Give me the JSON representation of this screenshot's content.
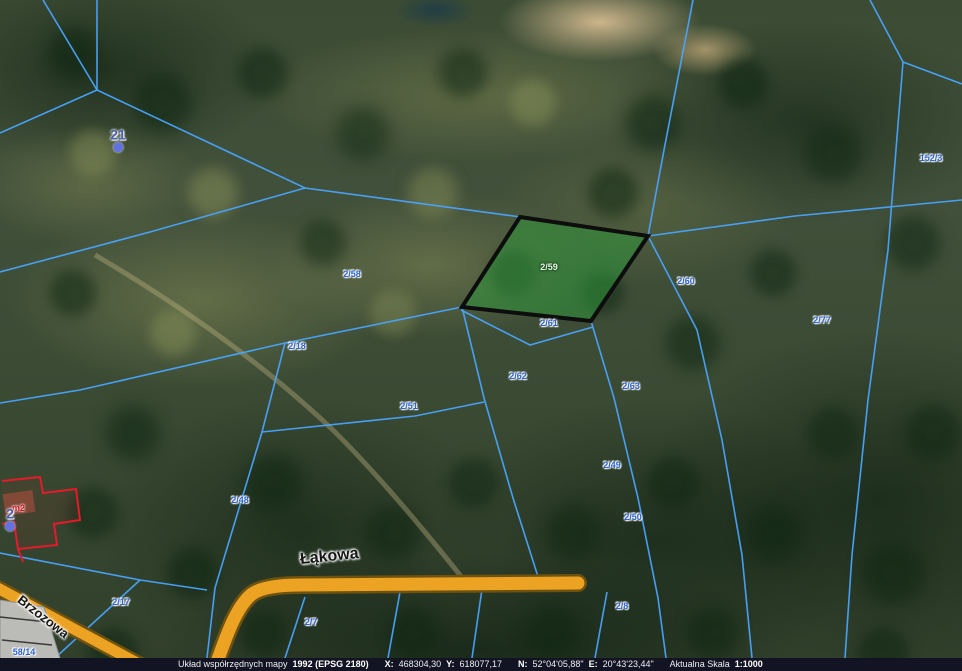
{
  "map": {
    "parcel_line_color": "#49a4ff",
    "road_color": "#eca223",
    "highlighted_parcel": {
      "label": "2/59",
      "fill": "#2e9e3c",
      "outline": "#0d0d0d"
    },
    "roads": [
      {
        "name": "Łąkowa"
      },
      {
        "name": "Brzozowa"
      }
    ],
    "building_label": "m2",
    "address_points": [
      {
        "label": "21",
        "x": 118,
        "y": 141
      },
      {
        "label": "2",
        "x": 10,
        "y": 520
      }
    ],
    "parcel_labels": [
      {
        "label": "152/3",
        "x": 931,
        "y": 158
      },
      {
        "label": "2/58",
        "x": 352,
        "y": 274
      },
      {
        "label": "2/59",
        "x": 549,
        "y": 267,
        "pale": true
      },
      {
        "label": "2/60",
        "x": 686,
        "y": 281
      },
      {
        "label": "2/77",
        "x": 822,
        "y": 320
      },
      {
        "label": "2/61",
        "x": 549,
        "y": 323
      },
      {
        "label": "2/18",
        "x": 297,
        "y": 346
      },
      {
        "label": "2/62",
        "x": 518,
        "y": 376
      },
      {
        "label": "2/63",
        "x": 631,
        "y": 386
      },
      {
        "label": "2/51",
        "x": 409,
        "y": 406
      },
      {
        "label": "2/49",
        "x": 612,
        "y": 465
      },
      {
        "label": "2/50",
        "x": 633,
        "y": 517
      },
      {
        "label": "2/48",
        "x": 240,
        "y": 500
      },
      {
        "label": "2/17",
        "x": 121,
        "y": 602
      },
      {
        "label": "2/7",
        "x": 311,
        "y": 622
      },
      {
        "label": "2/8",
        "x": 622,
        "y": 606
      },
      {
        "label": "58/14",
        "x": 24,
        "y": 652
      }
    ]
  },
  "statusbar": {
    "coord_system_label": "Układ współrzędnych mapy",
    "coord_system_value": "1992 (EPSG 2180)",
    "x_label": "X:",
    "x_value": "468304,30",
    "y_label": "Y:",
    "y_value": "618077,17",
    "n_label": "N:",
    "n_value": "52°04'05,88\"",
    "e_label": "E:",
    "e_value": "20°43'23,44\"",
    "scale_label": "Aktualna Skala",
    "scale_value": "1:1000"
  }
}
